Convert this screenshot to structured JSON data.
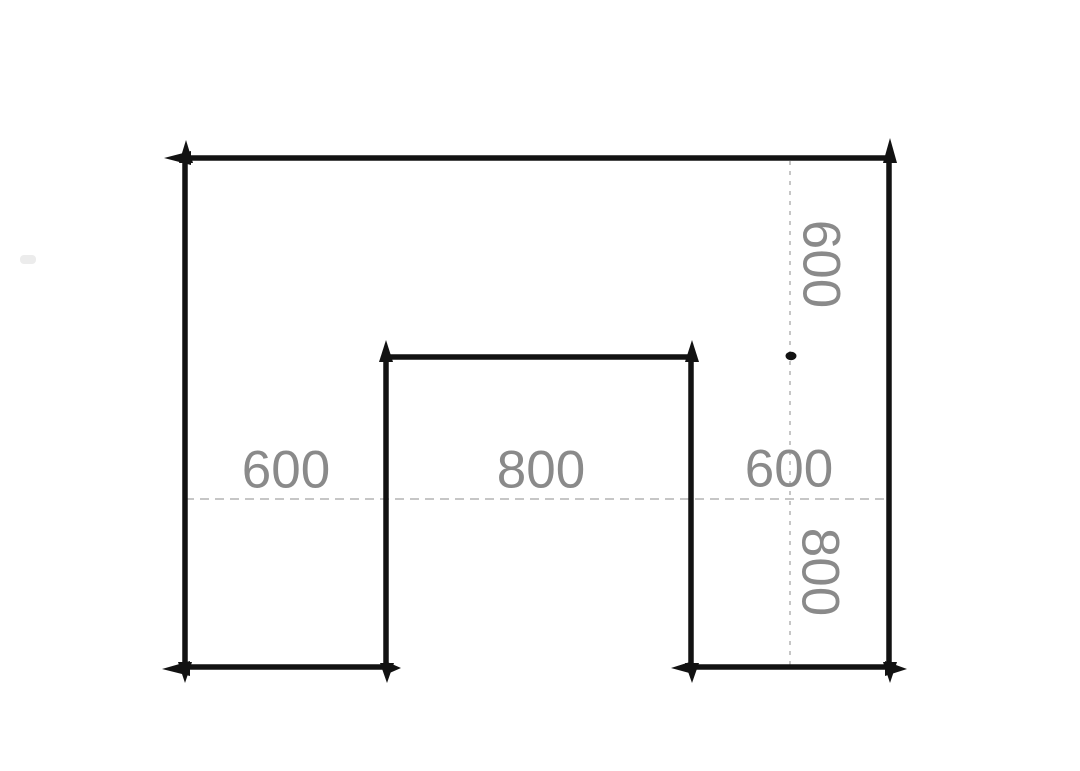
{
  "drawing": {
    "background_color": "#ffffff",
    "outline_color": "#121212",
    "guide_color": "#c6c6c6",
    "label_color": "#8a8a8a",
    "dimension_labels": {
      "width_left": "600",
      "width_center": "800",
      "width_right": "600",
      "height_upper_right": "600",
      "height_lower_right": "800"
    }
  }
}
